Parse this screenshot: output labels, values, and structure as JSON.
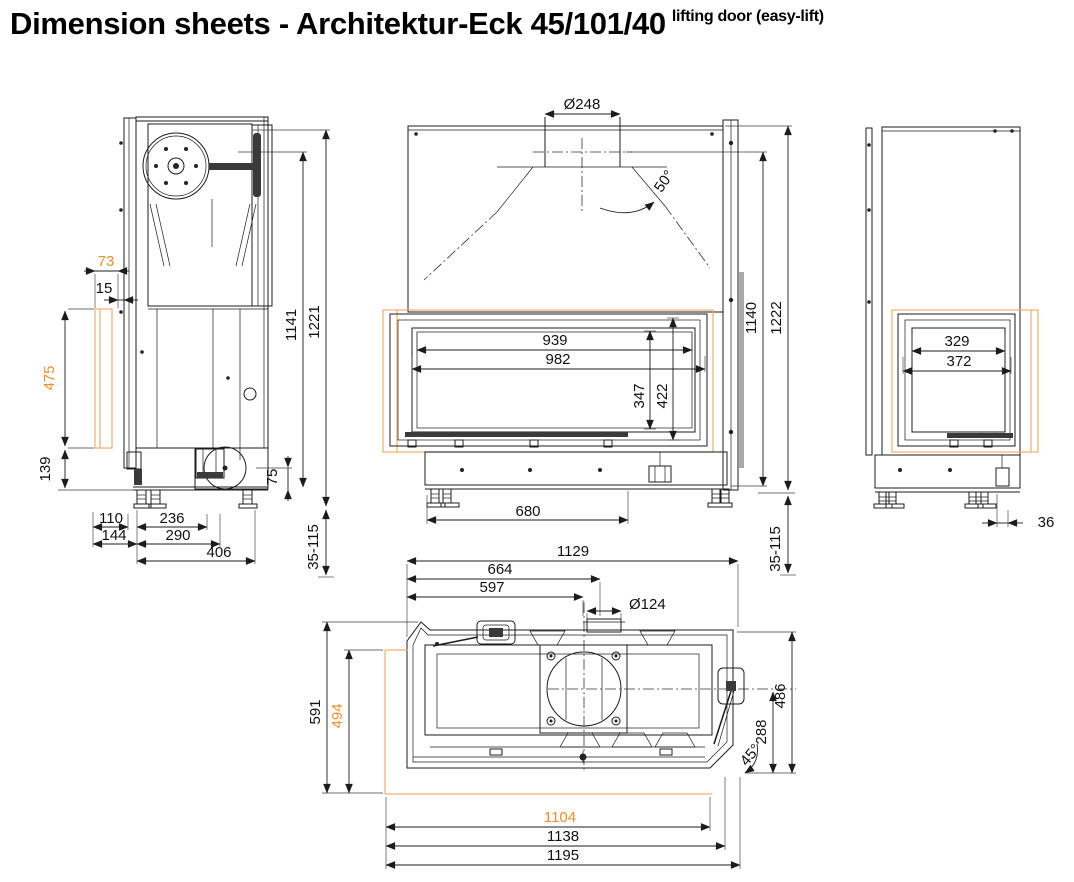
{
  "title": {
    "main": "Dimension sheets - Architektur-Eck 45/101/40",
    "superscript": "lifting door (easy-lift)"
  },
  "colors": {
    "line": "#1c1c1c",
    "accent": "#e8912d",
    "accent_light": "#f0b168",
    "shadow": "#aaaaaa"
  },
  "dims": {
    "side": {
      "glass_offset": "73",
      "glass_gap": "15",
      "glass_height": "475",
      "plinth_height": "139",
      "foot_inset": "110",
      "foot_span": "236",
      "depth_front": "144",
      "depth_mid": "290",
      "depth_total": "406",
      "flue_height": "75",
      "height_mechanism": "1141",
      "height_total": "1221",
      "leveling_range": "35-115"
    },
    "front": {
      "flue_diameter": "Ø248",
      "hood_angle": "50°",
      "glass_width": "939",
      "frame_width": "982",
      "glass_height": "347",
      "frame_height": "422",
      "foot_span": "680",
      "height_glass_top": "1140",
      "height_total": "1222",
      "leveling_range": "35-115"
    },
    "right": {
      "glass_width": "329",
      "frame_width": "372",
      "edge_offset": "36"
    },
    "top": {
      "width_body": "1129",
      "flue_center": "664",
      "flue_edge": "597",
      "flue_diameter": "Ø124",
      "depth_total": "591",
      "glass_depth": "494",
      "depth_body": "486",
      "depth_center": "288",
      "corner_angle": "45°",
      "glass_width": "1104",
      "frame_width": "1138",
      "width_total": "1195"
    }
  }
}
